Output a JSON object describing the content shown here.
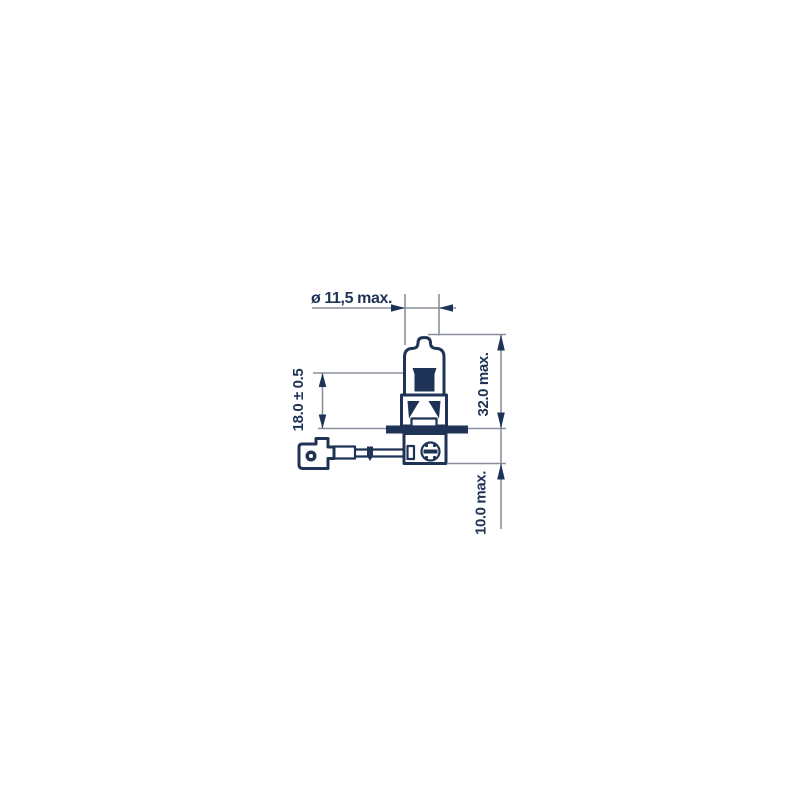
{
  "drawing": {
    "labels": {
      "diameter": "ø 11,5 max.",
      "light_center_length": "18.0 ± 0.5",
      "overall_length": "32.0 max.",
      "base_length": "10.0 max."
    },
    "colors": {
      "line": "#1e3356",
      "dim_line": "#8a909a",
      "background": "#ffffff"
    }
  }
}
